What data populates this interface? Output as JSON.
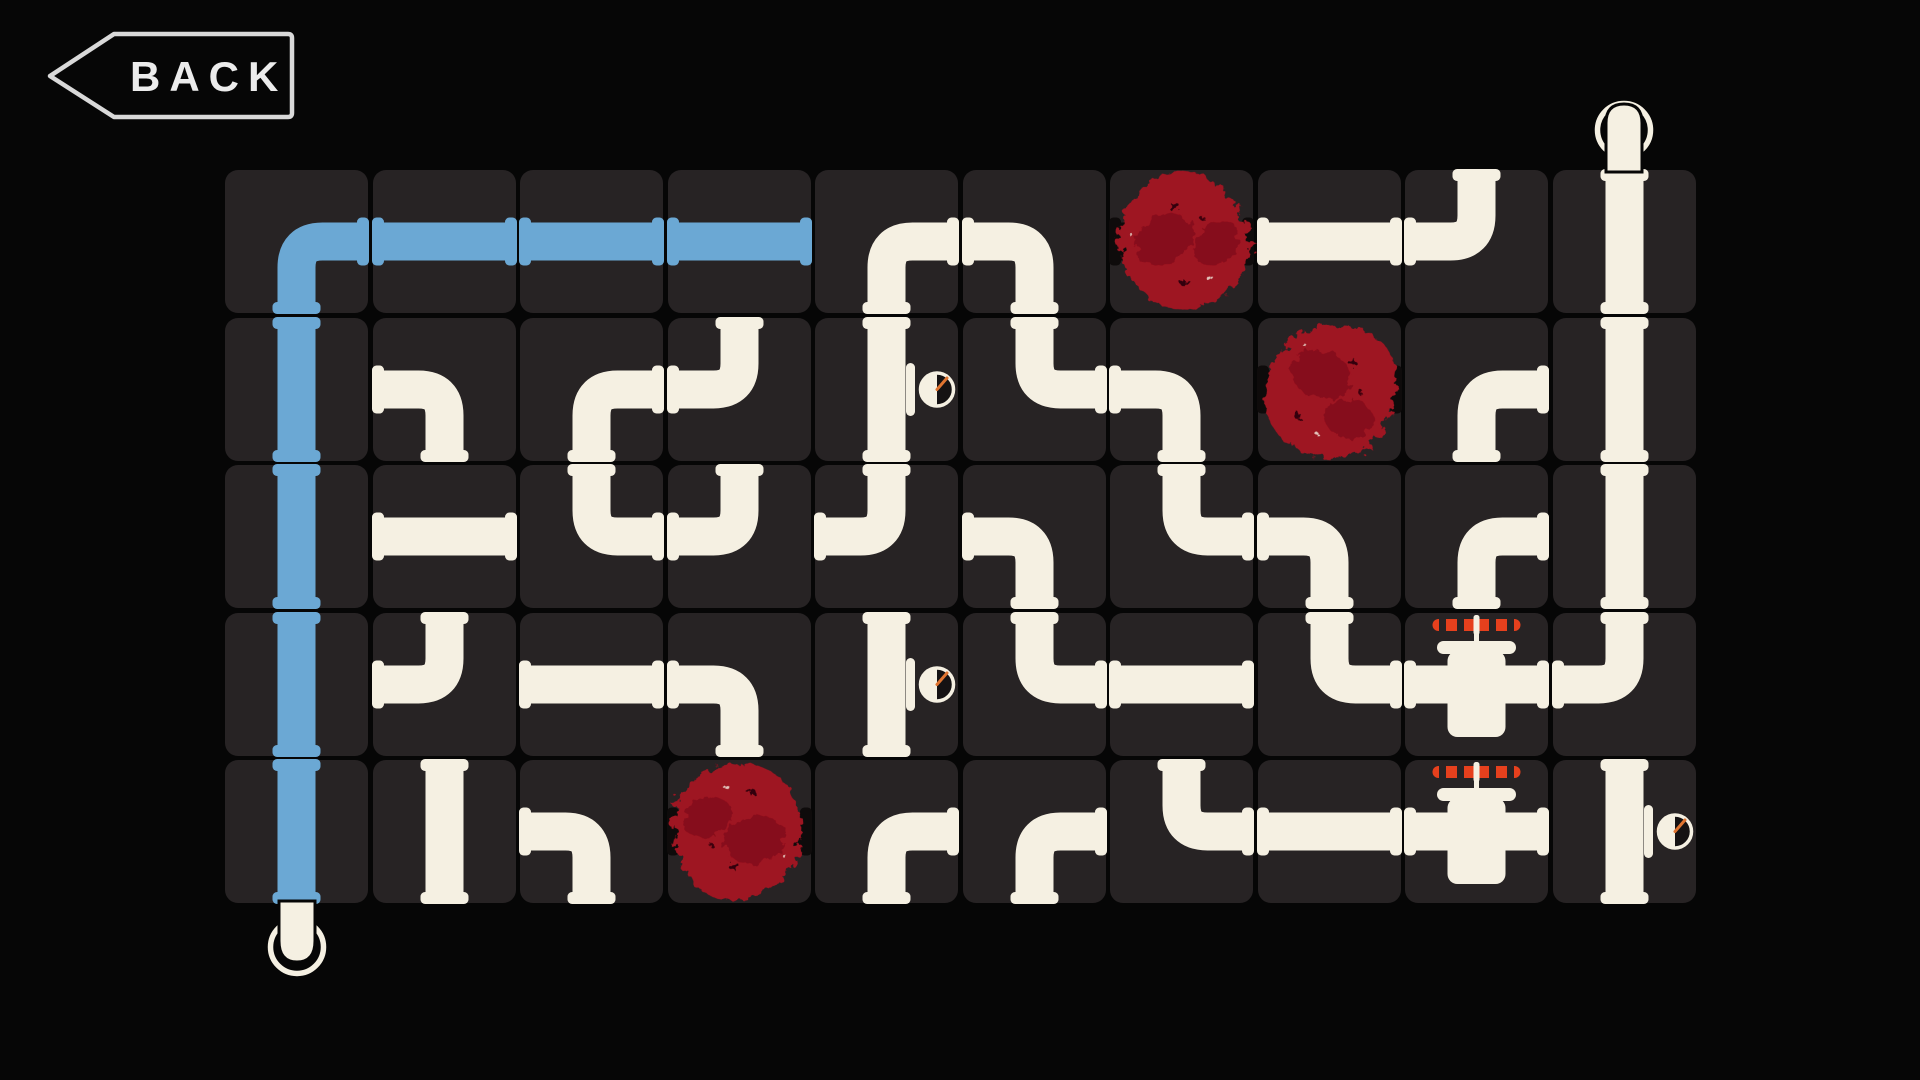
{
  "screen": {
    "width": 1920,
    "height": 1080
  },
  "colors": {
    "background": "#060606",
    "tile": "#272324",
    "pipe": "#f5f0e2",
    "water": "#6ba8d4",
    "pipe_dark": "#0e0b0b",
    "blob": "#9e1220",
    "blob_dark": "#6d0b14",
    "valve_handle": "#e6401d",
    "gauge_needle": "#e07430",
    "gauge_face": "#151213",
    "outline": "#d9d9d9",
    "back_text": "#ececec"
  },
  "back_button": {
    "label": "BACK",
    "icon": "left-arrow-outline"
  },
  "board": {
    "left": 225,
    "top": 170,
    "cols": 10,
    "rows": 5,
    "tile_size": 143,
    "gap": 4.5
  },
  "endpoints": [
    {
      "position": "top",
      "col": 9,
      "style": "ring-cap"
    },
    {
      "position": "bottom",
      "col": 0,
      "style": "ring-cap"
    }
  ],
  "tiles": [
    {
      "row": 0,
      "col": 0,
      "connections": "RB",
      "water": true,
      "overlay": null
    },
    {
      "row": 0,
      "col": 1,
      "connections": "LR",
      "water": true,
      "overlay": null
    },
    {
      "row": 0,
      "col": 2,
      "connections": "LR",
      "water": true,
      "overlay": null
    },
    {
      "row": 0,
      "col": 3,
      "connections": "LR",
      "water": true,
      "overlay": null
    },
    {
      "row": 0,
      "col": 4,
      "connections": "BR",
      "water": false,
      "overlay": null
    },
    {
      "row": 0,
      "col": 5,
      "connections": "LB",
      "water": false,
      "overlay": null
    },
    {
      "row": 0,
      "col": 6,
      "connections": "LR",
      "water": false,
      "overlay": "blob"
    },
    {
      "row": 0,
      "col": 7,
      "connections": "LR",
      "water": false,
      "overlay": null
    },
    {
      "row": 0,
      "col": 8,
      "connections": "TL",
      "water": false,
      "overlay": null
    },
    {
      "row": 0,
      "col": 9,
      "connections": "TB",
      "water": false,
      "overlay": null
    },
    {
      "row": 1,
      "col": 0,
      "connections": "TB",
      "water": true,
      "overlay": null
    },
    {
      "row": 1,
      "col": 1,
      "connections": "LB",
      "water": false,
      "overlay": null
    },
    {
      "row": 1,
      "col": 2,
      "connections": "BR",
      "water": false,
      "overlay": null
    },
    {
      "row": 1,
      "col": 3,
      "connections": "TL",
      "water": false,
      "overlay": null
    },
    {
      "row": 1,
      "col": 4,
      "connections": "TB",
      "water": false,
      "overlay": "gauge"
    },
    {
      "row": 1,
      "col": 5,
      "connections": "TR",
      "water": false,
      "overlay": null
    },
    {
      "row": 1,
      "col": 6,
      "connections": "LB",
      "water": false,
      "overlay": null
    },
    {
      "row": 1,
      "col": 7,
      "connections": "LR",
      "water": false,
      "overlay": "blob"
    },
    {
      "row": 1,
      "col": 8,
      "connections": "BR",
      "water": false,
      "overlay": null
    },
    {
      "row": 1,
      "col": 9,
      "connections": "TB",
      "water": false,
      "overlay": null
    },
    {
      "row": 2,
      "col": 0,
      "connections": "TB",
      "water": true,
      "overlay": null
    },
    {
      "row": 2,
      "col": 1,
      "connections": "LR",
      "water": false,
      "overlay": null
    },
    {
      "row": 2,
      "col": 2,
      "connections": "TR",
      "water": false,
      "overlay": null
    },
    {
      "row": 2,
      "col": 3,
      "connections": "TL",
      "water": false,
      "overlay": null
    },
    {
      "row": 2,
      "col": 4,
      "connections": "TL",
      "water": false,
      "overlay": null
    },
    {
      "row": 2,
      "col": 5,
      "connections": "LB",
      "water": false,
      "overlay": null
    },
    {
      "row": 2,
      "col": 6,
      "connections": "TR",
      "water": false,
      "overlay": null
    },
    {
      "row": 2,
      "col": 7,
      "connections": "LB",
      "water": false,
      "overlay": null
    },
    {
      "row": 2,
      "col": 8,
      "connections": "BR",
      "water": false,
      "overlay": null
    },
    {
      "row": 2,
      "col": 9,
      "connections": "TB",
      "water": false,
      "overlay": null
    },
    {
      "row": 3,
      "col": 0,
      "connections": "TB",
      "water": true,
      "overlay": null
    },
    {
      "row": 3,
      "col": 1,
      "connections": "TL",
      "water": false,
      "overlay": null
    },
    {
      "row": 3,
      "col": 2,
      "connections": "LR",
      "water": false,
      "overlay": null
    },
    {
      "row": 3,
      "col": 3,
      "connections": "LB",
      "water": false,
      "overlay": null
    },
    {
      "row": 3,
      "col": 4,
      "connections": "TB",
      "water": false,
      "overlay": "gauge"
    },
    {
      "row": 3,
      "col": 5,
      "connections": "TR",
      "water": false,
      "overlay": null
    },
    {
      "row": 3,
      "col": 6,
      "connections": "LR",
      "water": false,
      "overlay": null
    },
    {
      "row": 3,
      "col": 7,
      "connections": "TR",
      "water": false,
      "overlay": null
    },
    {
      "row": 3,
      "col": 8,
      "connections": "LR",
      "water": false,
      "overlay": "valve"
    },
    {
      "row": 3,
      "col": 9,
      "connections": "TL",
      "water": false,
      "overlay": null
    },
    {
      "row": 4,
      "col": 0,
      "connections": "TB",
      "water": true,
      "overlay": null
    },
    {
      "row": 4,
      "col": 1,
      "connections": "TB",
      "water": false,
      "overlay": null
    },
    {
      "row": 4,
      "col": 2,
      "connections": "LB",
      "water": false,
      "overlay": null
    },
    {
      "row": 4,
      "col": 3,
      "connections": "LR",
      "water": false,
      "overlay": "blob"
    },
    {
      "row": 4,
      "col": 4,
      "connections": "BR",
      "water": false,
      "overlay": null
    },
    {
      "row": 4,
      "col": 5,
      "connections": "BR",
      "water": false,
      "overlay": null
    },
    {
      "row": 4,
      "col": 6,
      "connections": "TR",
      "water": false,
      "overlay": null
    },
    {
      "row": 4,
      "col": 7,
      "connections": "LR",
      "water": false,
      "overlay": null
    },
    {
      "row": 4,
      "col": 8,
      "connections": "LR",
      "water": false,
      "overlay": "valve"
    },
    {
      "row": 4,
      "col": 9,
      "connections": "TB",
      "water": false,
      "overlay": "gauge"
    }
  ]
}
